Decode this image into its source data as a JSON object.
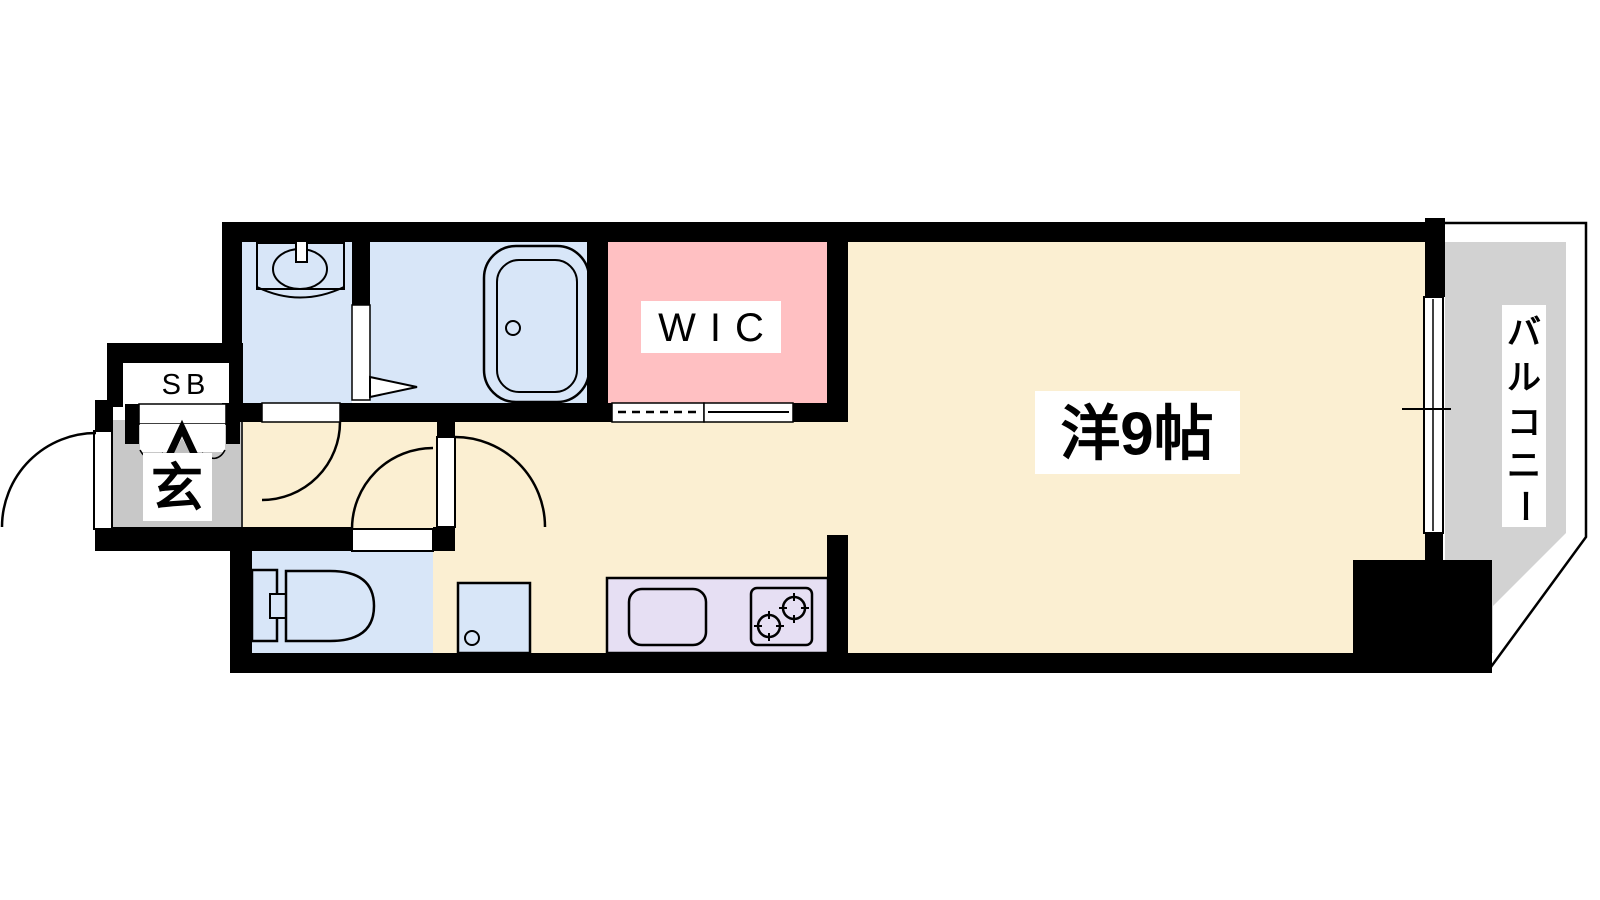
{
  "plan": {
    "type": "floor-plan",
    "labels": {
      "shoe_box": "SB",
      "entrance": "玄",
      "walk_in_closet": "WIC",
      "main_room": "洋9帖",
      "balcony": "バルコニー"
    },
    "balcony_chars": [
      "バ",
      "ル",
      "コ",
      "ニ",
      "ー"
    ],
    "rooms": [
      {
        "name": "washroom",
        "color_key": "wet_blue"
      },
      {
        "name": "bathroom",
        "color_key": "wet_blue"
      },
      {
        "name": "walk-in-closet",
        "color_key": "wic_pink"
      },
      {
        "name": "main-room",
        "color_key": "room_cream"
      },
      {
        "name": "hallway-kitchen",
        "color_key": "room_cream"
      },
      {
        "name": "toilet-room",
        "color_key": "wet_blue"
      },
      {
        "name": "washer-space",
        "color_key": "wet_blue"
      },
      {
        "name": "kitchen-counter",
        "color_key": "kitchen_lavender"
      },
      {
        "name": "entrance",
        "color_key": "entrance_gray"
      },
      {
        "name": "balcony",
        "color_key": "balcony_gray"
      }
    ],
    "fixtures": [
      "washbasin-icon",
      "bathtub-icon",
      "toilet-icon",
      "washer-circle-icon",
      "kitchen-sink-icon",
      "stove-burners-icon",
      "entrance-step-arrow-icon",
      "door-swing-arcs",
      "sliding-closet-door",
      "balcony-window"
    ],
    "colors": {
      "wall": "#000000",
      "room_cream": "#FBEFD2",
      "wet_blue": "#D8E6F8",
      "wic_pink": "#FFC0C2",
      "kitchen_lavender": "#E6DFF3",
      "entrance_gray": "#C8C8C8",
      "balcony_gray": "#D2D2D2",
      "label_bg": "#FFFFFF",
      "step_shadow": "#BFBFBF"
    }
  }
}
